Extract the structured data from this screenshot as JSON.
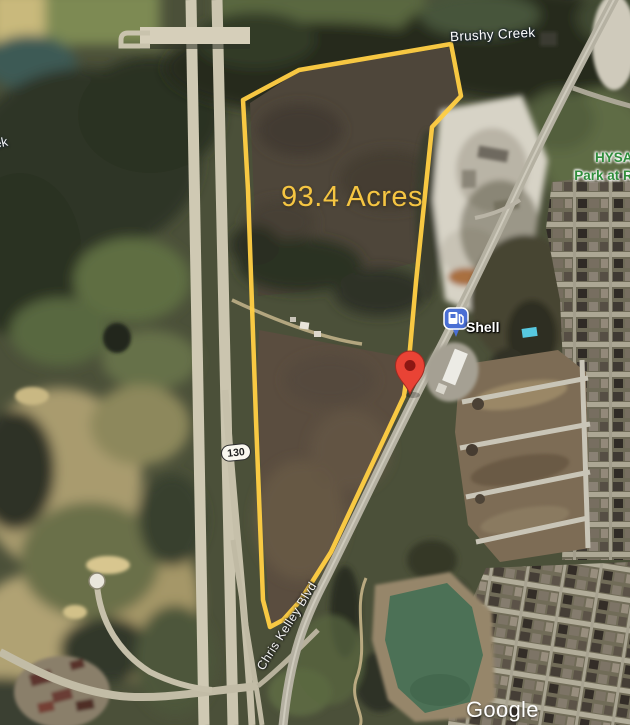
{
  "map": {
    "parcel": {
      "acreage_label": "93.4 Acres",
      "outline_color": "#FFCE44"
    },
    "labels": {
      "creek": "Brushy Creek",
      "creek_partial": "ek",
      "park_line1": "HYSA T",
      "park_line2": "Park at Riv",
      "gas_station": "Shell",
      "road": "Chris Kelley Blvd",
      "highway_shield": "130",
      "watermark": "Google"
    },
    "colors": {
      "acreage_text": "#F5C542",
      "park_text": "#2F8D3B",
      "property_pin": "#E94335",
      "property_pin_inner": "#8C1713",
      "gas_pin": "#4A6FD4",
      "pond_water": "#4C7156"
    }
  }
}
